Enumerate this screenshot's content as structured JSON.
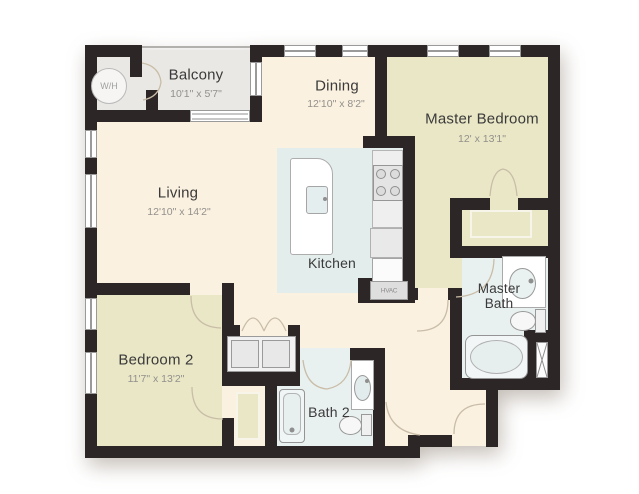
{
  "floor_plan": {
    "rooms": {
      "balcony": {
        "name": "Balcony",
        "dims": "10'1\" x 5'7\""
      },
      "dining": {
        "name": "Dining",
        "dims": "12'10\" x 8'2\""
      },
      "master_bedroom": {
        "name": "Master Bedroom",
        "dims": "12' x 13'1\""
      },
      "living": {
        "name": "Living",
        "dims": "12'10\" x 14'2\""
      },
      "kitchen": {
        "name": "Kitchen"
      },
      "master_bath": {
        "name": "Master Bath"
      },
      "bedroom2": {
        "name": "Bedroom 2",
        "dims": "11'7\" x 13'2\""
      },
      "bath2": {
        "name": "Bath 2"
      }
    },
    "annotations": {
      "water_heater": "W/H",
      "hvac": "HVAC"
    },
    "colors": {
      "wall": "#2c2626",
      "floor_main": "#fbf1e0",
      "floor_bedroom": "#eae7c6",
      "floor_kitchen": "#e3edec",
      "floor_bath": "#e9f1f0",
      "floor_balcony": "#eae8e4",
      "door_arc": "#c9bda8",
      "fixture_border": "#9b9b9b"
    }
  }
}
